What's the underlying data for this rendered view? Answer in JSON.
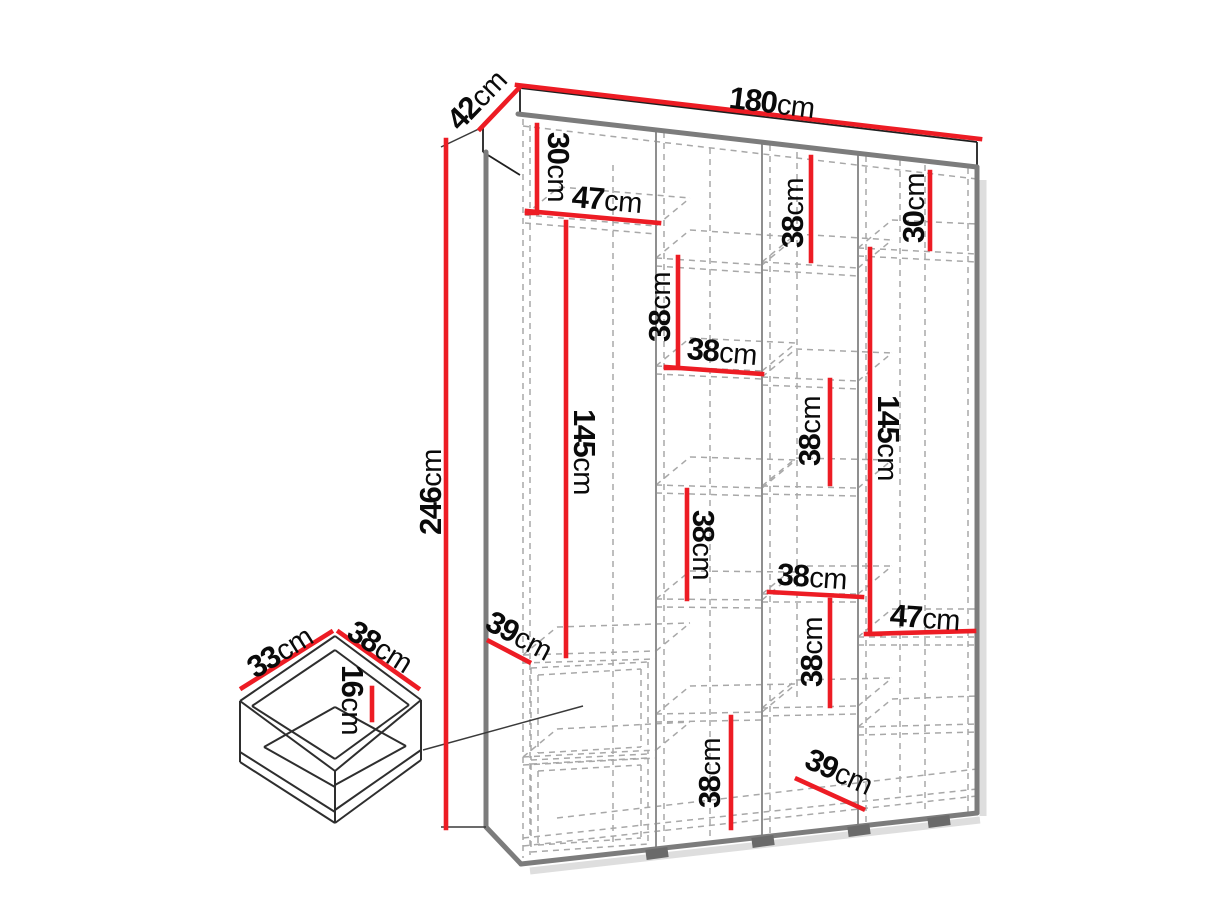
{
  "diagram": {
    "kind": "wardrobe-dimension-diagram",
    "background": "#ffffff",
    "accent_color": "#ed1c24",
    "edge_color": "#7c7c7c",
    "dash_color": "#a8a8a8",
    "text_color": "#0a0a0a",
    "overall": {
      "width": "180cm",
      "depth": "42cm",
      "height": "246cm"
    },
    "drawer_detail": {
      "depth": "33cm",
      "width": "38cm",
      "inner_height": "16cm"
    },
    "labels": [
      {
        "part": "depth-top",
        "value": "42",
        "unit": "cm",
        "x": 477,
        "y": 100,
        "rot": -46
      },
      {
        "part": "width-top",
        "value": "180",
        "unit": "cm",
        "x": 772,
        "y": 103,
        "rot": 7
      },
      {
        "part": "upper-left-shelf-height",
        "value": "30",
        "unit": "cm",
        "x": 558,
        "y": 167,
        "rot": 90
      },
      {
        "part": "upper-left-shelf-width",
        "value": "47",
        "unit": "cm",
        "x": 607,
        "y": 200,
        "rot": 5
      },
      {
        "part": "col3-top-shelf-gap",
        "value": "38",
        "unit": "cm",
        "x": 793,
        "y": 213,
        "rot": -90
      },
      {
        "part": "col4-top-shelf-height",
        "value": "30",
        "unit": "cm",
        "x": 914,
        "y": 208,
        "rot": -90
      },
      {
        "part": "col2-upper-shelf-gap",
        "value": "38",
        "unit": "cm",
        "x": 660,
        "y": 307,
        "rot": -90
      },
      {
        "part": "col2-shelf-width",
        "value": "38",
        "unit": "cm",
        "x": 722,
        "y": 352,
        "rot": 5
      },
      {
        "part": "col1-hanging-height",
        "value": "145",
        "unit": "cm",
        "x": 584,
        "y": 452,
        "rot": 90
      },
      {
        "part": "col4-hanging-height",
        "value": "145",
        "unit": "cm",
        "x": 888,
        "y": 438,
        "rot": 90
      },
      {
        "part": "col3-mid-shelf-gap",
        "value": "38",
        "unit": "cm",
        "x": 810,
        "y": 431,
        "rot": -90
      },
      {
        "part": "total-height",
        "value": "246",
        "unit": "cm",
        "x": 431,
        "y": 492,
        "rot": -90
      },
      {
        "part": "col2-mid-shelf-gap",
        "value": "38",
        "unit": "cm",
        "x": 703,
        "y": 545,
        "rot": 90
      },
      {
        "part": "col3-shelf-width",
        "value": "38",
        "unit": "cm",
        "x": 812,
        "y": 577,
        "rot": 4
      },
      {
        "part": "col4-shelf-width",
        "value": "47",
        "unit": "cm",
        "x": 925,
        "y": 618,
        "rot": 4
      },
      {
        "part": "col1-shelf-depth",
        "value": "39",
        "unit": "cm",
        "x": 519,
        "y": 636,
        "rot": 28
      },
      {
        "part": "col3-lower-shelf-gap",
        "value": "38",
        "unit": "cm",
        "x": 812,
        "y": 652,
        "rot": -90
      },
      {
        "part": "col2-bottom-shelf-gap",
        "value": "38",
        "unit": "cm",
        "x": 710,
        "y": 773,
        "rot": -90
      },
      {
        "part": "col4-bottom-shelf-depth",
        "value": "39",
        "unit": "cm",
        "x": 839,
        "y": 772,
        "rot": 24
      },
      {
        "part": "drawer-depth",
        "value": "33",
        "unit": "cm",
        "x": 280,
        "y": 652,
        "rot": -32
      },
      {
        "part": "drawer-width",
        "value": "38",
        "unit": "cm",
        "x": 380,
        "y": 647,
        "rot": 32
      },
      {
        "part": "drawer-inner-height",
        "value": "16",
        "unit": "cm",
        "x": 352,
        "y": 700,
        "rot": 90
      }
    ]
  }
}
